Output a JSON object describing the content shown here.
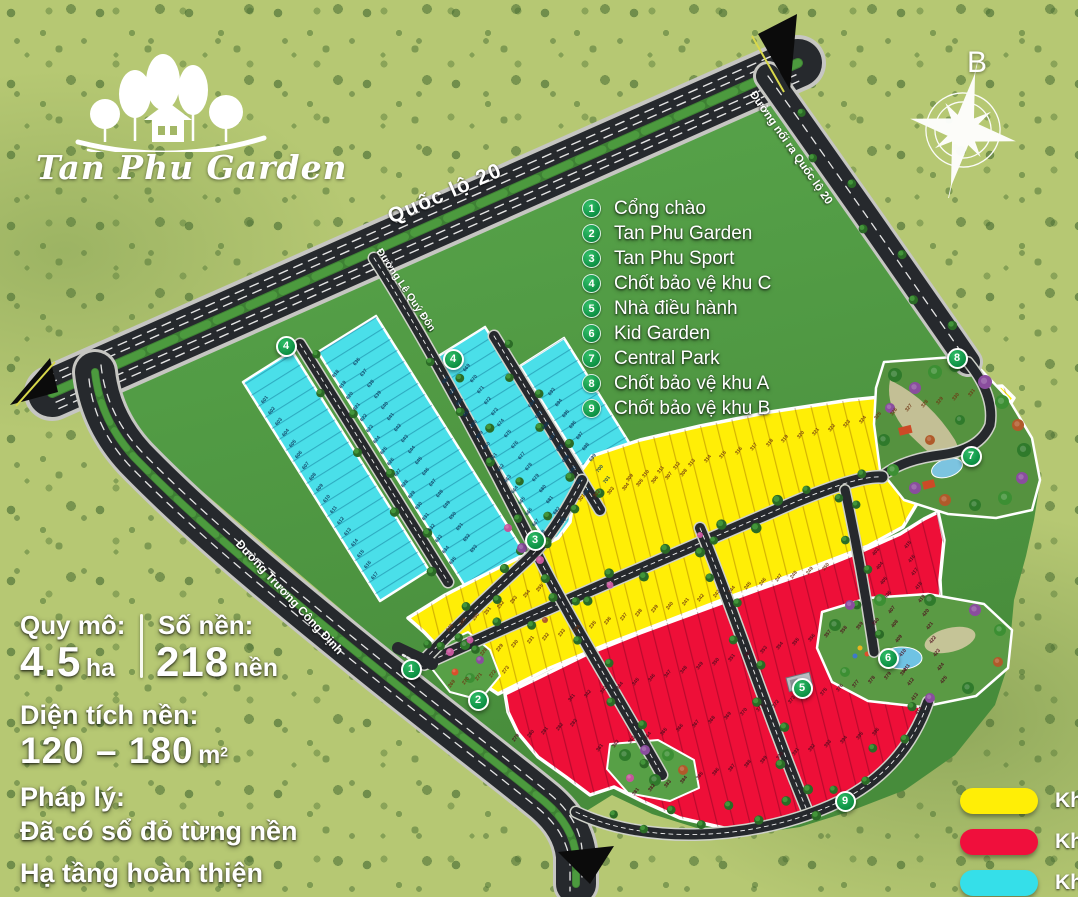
{
  "logo": {
    "title": "Tan Phu Garden"
  },
  "compass": {
    "label": "B"
  },
  "legend": {
    "items": [
      {
        "num": "1",
        "label": "Cổng chào"
      },
      {
        "num": "2",
        "label": "Tan Phu Garden"
      },
      {
        "num": "3",
        "label": "Tan Phu Sport"
      },
      {
        "num": "4",
        "label": "Chốt bảo vệ khu C"
      },
      {
        "num": "5",
        "label": "Nhà điều hành"
      },
      {
        "num": "6",
        "label": "Kid Garden"
      },
      {
        "num": "7",
        "label": "Central Park"
      },
      {
        "num": "8",
        "label": "Chốt bảo vệ khu A"
      },
      {
        "num": "9",
        "label": "Chốt bảo vệ khu B"
      }
    ]
  },
  "stats": {
    "scale_label": "Quy mô:",
    "scale_value": "4.5",
    "scale_unit": "ha",
    "lots_label": "Số nền:",
    "lots_value": "218",
    "lots_unit": "nền",
    "area_label": "Diện tích nền:",
    "area_value": "120 – 180",
    "area_unit": "m",
    "area_sup": "2",
    "legal_label": "Pháp lý:",
    "legal_value": "Đã có sổ đỏ từng nền",
    "infra": "Hạ tầng hoàn thiện"
  },
  "roads": {
    "ql20": "Quốc lộ 20",
    "connector": "Đường nối ra Quốc lộ 20",
    "le_quy_don": "Đường Lê Quý Đôn",
    "truong_cong_dinh": "Đường Trương Công Định"
  },
  "zone_legend": [
    {
      "label": "Khu",
      "color": "#ffee06"
    },
    {
      "label": "Khu",
      "color": "#f00f3c"
    },
    {
      "label": "Khu",
      "color": "#35dfe9"
    }
  ],
  "markers": [
    {
      "num": "1",
      "x": 411,
      "y": 669
    },
    {
      "num": "2",
      "x": 478,
      "y": 700
    },
    {
      "num": "3",
      "x": 535,
      "y": 540
    },
    {
      "num": "4",
      "x": 286,
      "y": 346
    },
    {
      "num": "4",
      "x": 453,
      "y": 359
    },
    {
      "num": "5",
      "x": 802,
      "y": 688
    },
    {
      "num": "6",
      "x": 888,
      "y": 658
    },
    {
      "num": "7",
      "x": 971,
      "y": 456
    },
    {
      "num": "8",
      "x": 957,
      "y": 358
    },
    {
      "num": "9",
      "x": 845,
      "y": 801
    }
  ],
  "plot_lines": [
    {
      "x": 265,
      "y": 400,
      "dir": 58,
      "step": 13,
      "count": 17,
      "start": 601,
      "color": "#0e3a5e"
    },
    {
      "x": 336,
      "y": 374,
      "dir": 58,
      "step": 13,
      "count": 18,
      "start": 618,
      "color": "#0e3a5e"
    },
    {
      "x": 357,
      "y": 362,
      "dir": 58,
      "step": 13,
      "count": 18,
      "start": 636,
      "color": "#0e3a5e"
    },
    {
      "x": 446,
      "y": 380,
      "dir": 58,
      "step": 13,
      "count": 15,
      "start": 654,
      "color": "#0e3a5e"
    },
    {
      "x": 467,
      "y": 368,
      "dir": 58,
      "step": 13,
      "count": 15,
      "start": 669,
      "color": "#0e3a5e"
    },
    {
      "x": 532,
      "y": 404,
      "dir": 58,
      "step": 13,
      "count": 9,
      "start": 684,
      "color": "#0e3a5e"
    },
    {
      "x": 552,
      "y": 392,
      "dir": 58,
      "step": 13,
      "count": 9,
      "start": 693,
      "color": "#0e3a5e"
    },
    {
      "x": 582,
      "y": 498,
      "dir": -14,
      "step": 15,
      "count": 8,
      "start": 301,
      "color": "#6e3512"
    },
    {
      "x": 630,
      "y": 478,
      "dir": -14,
      "step": 16,
      "count": 23,
      "start": 309,
      "color": "#6e3512"
    },
    {
      "x": 484,
      "y": 652,
      "dir": -14,
      "step": 16,
      "count": 23,
      "start": 228,
      "color": "#6e3512"
    },
    {
      "x": 452,
      "y": 684,
      "dir": -14,
      "step": 14,
      "count": 5,
      "start": 269,
      "color": "#6e3512"
    },
    {
      "x": 450,
      "y": 628,
      "dir": -24,
      "step": 14,
      "count": 8,
      "start": 248,
      "color": "#6e3512"
    },
    {
      "x": 516,
      "y": 738,
      "dir": -14,
      "step": 15,
      "count": 5,
      "start": 279,
      "color": "#4d0c1c"
    },
    {
      "x": 572,
      "y": 698,
      "dir": -14,
      "step": 16.5,
      "count": 20,
      "start": 341,
      "color": "#4d0c1c"
    },
    {
      "x": 600,
      "y": 748,
      "dir": -14,
      "step": 16.5,
      "count": 20,
      "start": 361,
      "color": "#4d0c1c"
    },
    {
      "x": 636,
      "y": 792,
      "dir": -14,
      "step": 16.5,
      "count": 16,
      "start": 381,
      "color": "#4d0c1c"
    },
    {
      "x": 876,
      "y": 552,
      "dir": 75,
      "step": 15,
      "count": 12,
      "start": 403,
      "color": "#4d0c1c"
    },
    {
      "x": 908,
      "y": 545,
      "dir": 75,
      "step": 14,
      "count": 11,
      "start": 415,
      "color": "#4d0c1c"
    }
  ],
  "colors": {
    "zone_yellow": "#ffee06",
    "zone_red": "#ee0f38",
    "zone_cyan": "#4adfe9",
    "marker_green": "#12a150",
    "road_dark": "#26292d"
  }
}
